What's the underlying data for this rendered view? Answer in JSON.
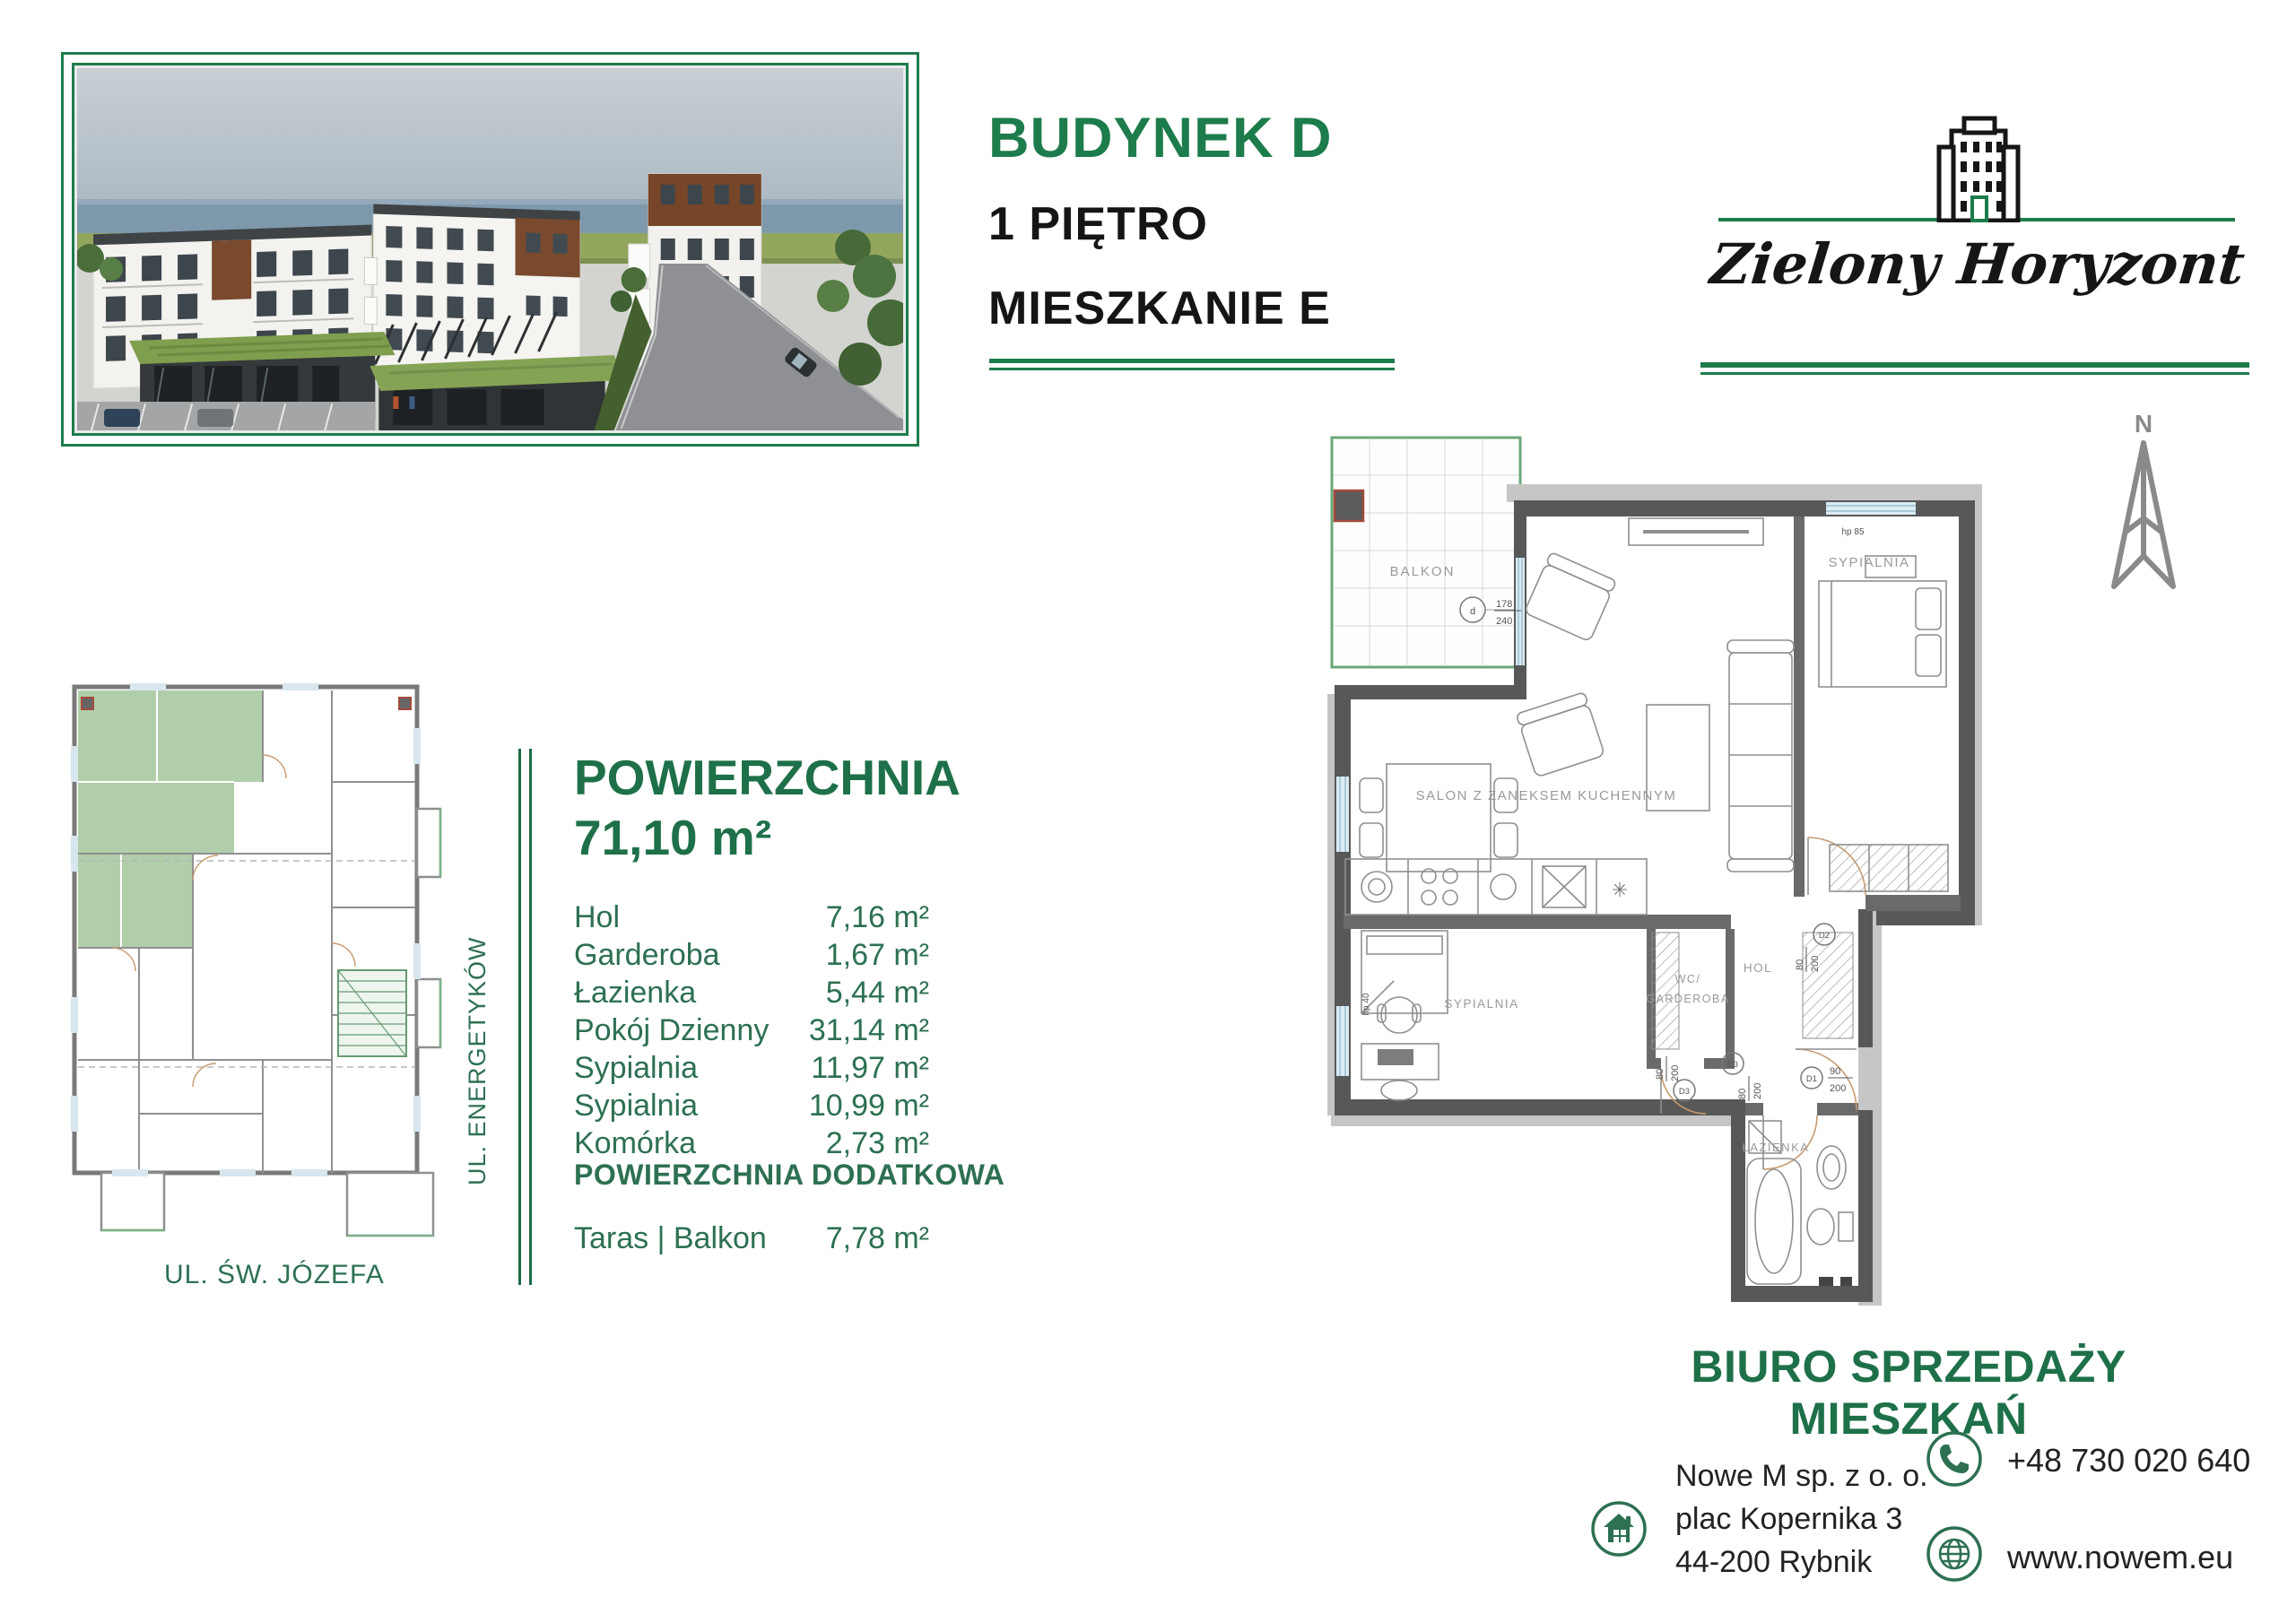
{
  "header": {
    "building": "BUDYNEK D",
    "floor": "1 PIĘTRO",
    "apartment": "MIESZKANIE E"
  },
  "logo": {
    "brand": "Zielony Horyzont"
  },
  "compass": {
    "north": "N"
  },
  "site_plan": {
    "street_side": "UL. ENERGETYKÓW",
    "street_bottom": "UL. ŚW. JÓZEFA"
  },
  "area": {
    "title": "POWIERZCHNIA",
    "total": "71,10 m²",
    "rooms": [
      {
        "label": "Hol",
        "value": "7,16 m²"
      },
      {
        "label": "Garderoba",
        "value": "1,67 m²"
      },
      {
        "label": "Łazienka",
        "value": "5,44 m²"
      },
      {
        "label": "Pokój Dzienny",
        "value": "31,14 m²"
      },
      {
        "label": "Sypialnia",
        "value": "11,97 m²"
      },
      {
        "label": "Sypialnia",
        "value": "10,99 m²"
      },
      {
        "label": "Komórka",
        "value": "2,73 m²"
      }
    ],
    "additional_title": "POWIERZCHNIA DODATKOWA",
    "additional_rooms": [
      {
        "label": "Taras | Balkon",
        "value": "7,78 m²"
      }
    ]
  },
  "floor_plan": {
    "rooms": {
      "balcony": "BALKON",
      "bedroom_top": "SYPIALNIA",
      "living": "SALON Z ZANEKSEM KUCHENNYM",
      "wc_line1": "WC/",
      "wc_line2": "GARDEROBA",
      "hall": "HOL",
      "bedroom_bottom": "SYPIALNIA",
      "bathroom": "ŁAZIENKA"
    },
    "markers": {
      "balcony_window_sym": "d",
      "balcony_window_num": "178",
      "balcony_window_den": "240",
      "hp_top": "hp 85",
      "hp_left": "hp 40",
      "d1": "D1",
      "d1_num": "90",
      "d1_den": "200",
      "d2": "D2",
      "d2_num": "80",
      "d2_den": "200",
      "d3a": "D3",
      "d3a_num": "80",
      "d3a_den": "200",
      "d3b": "D3",
      "d3b_num": "80",
      "d3b_den": "200"
    }
  },
  "contact": {
    "title": "BIURO SPRZEDAŻY MIESZKAŃ",
    "company": "Nowe M sp. z o. o.",
    "address1": "plac Kopernika 3",
    "address2": "44-200 Rybnik",
    "phone": "+48 730 020 640",
    "website": "www.nowem.eu"
  },
  "colors": {
    "brand_green": "#1d7c4b",
    "text_green": "#2d7052",
    "wall_gray": "#585858",
    "marker_red": "#a34a3c"
  }
}
